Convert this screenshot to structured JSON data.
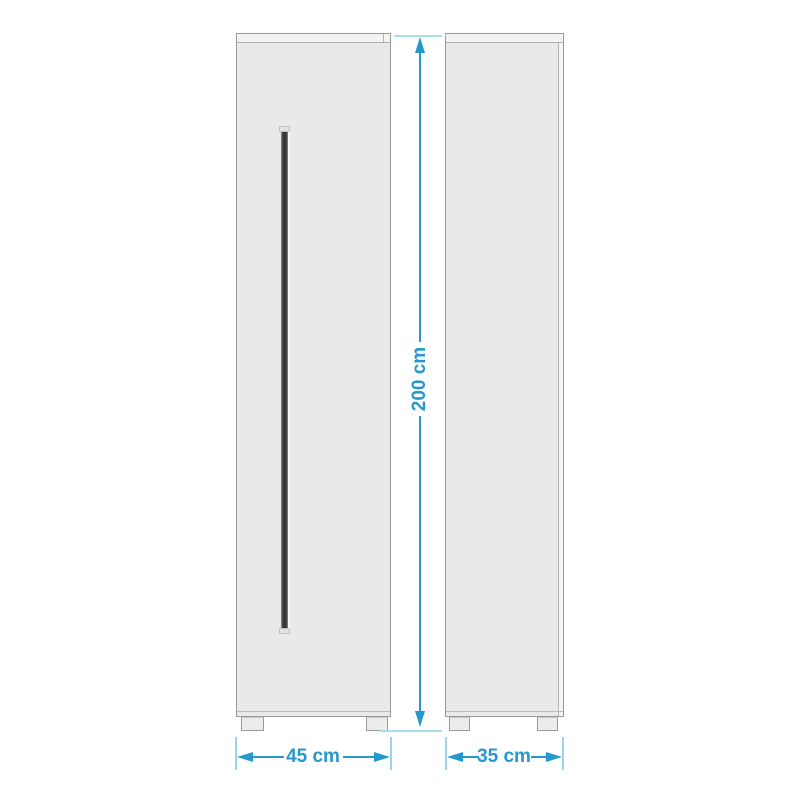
{
  "diagram": {
    "title": "cabinet-dimension-diagram",
    "views": {
      "front": {
        "name": "front view with vertical bar handle"
      },
      "side": {
        "name": "side view panel"
      }
    },
    "dimensions": {
      "height": {
        "label": "200 cm"
      },
      "width": {
        "label": "45 cm"
      },
      "depth": {
        "label": "35 cm"
      }
    },
    "colors": {
      "dimension_accent": "#2598cc",
      "dimension_extension": "#aadcee",
      "panel_fill": "#e9e9e9",
      "panel_border": "#9a9a9a",
      "panel_top_strip": "#f3f3f3",
      "handle_dark": "#2f2f2f",
      "background": "#ffffff"
    }
  }
}
